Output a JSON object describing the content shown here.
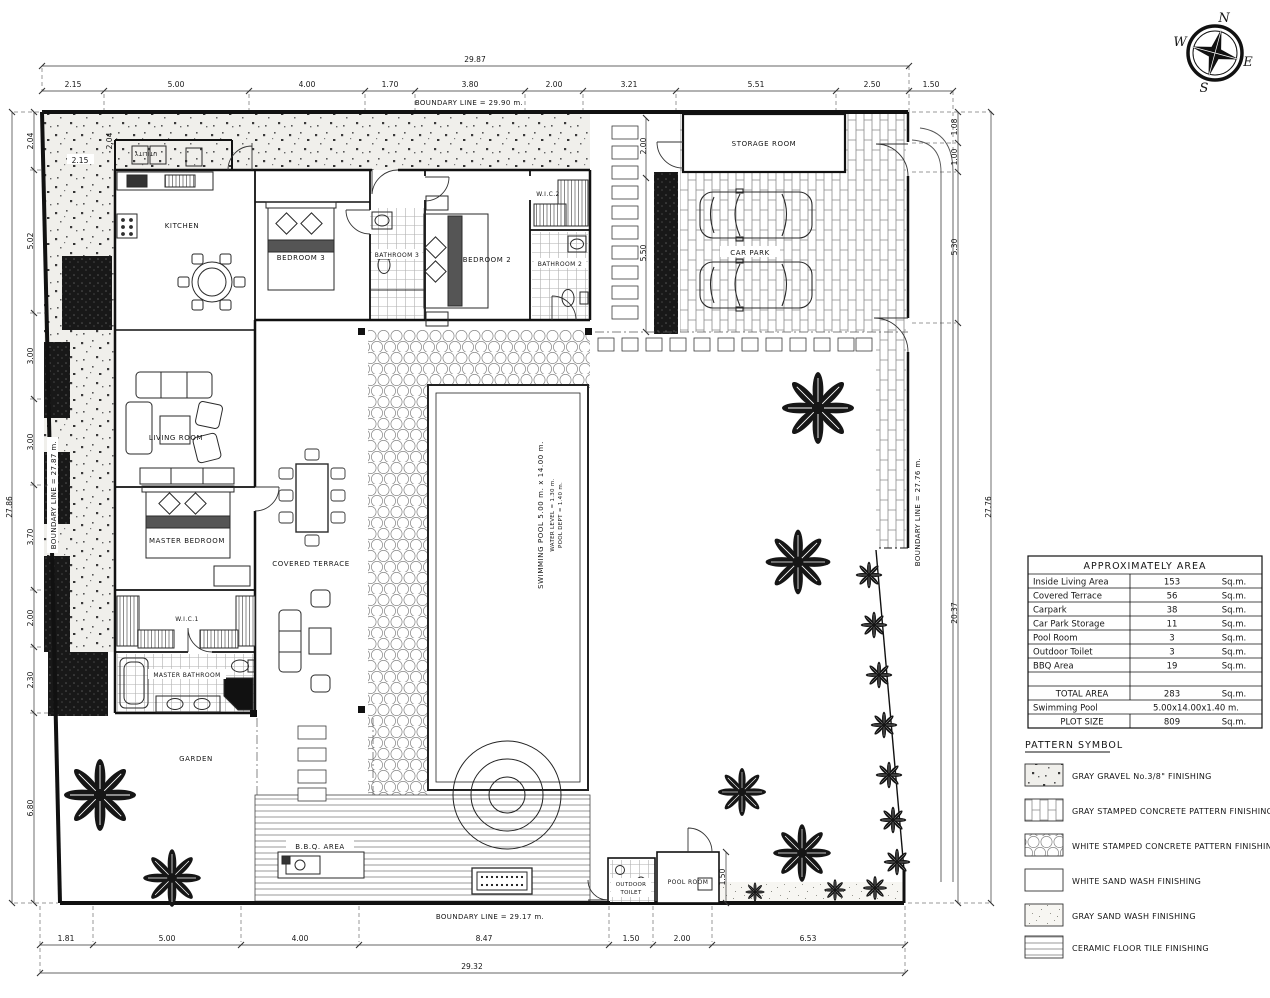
{
  "compass": {
    "n": "N",
    "e": "E",
    "s": "S",
    "w": "W"
  },
  "boundary": {
    "top": "BOUNDARY LINE = 29.90 m.",
    "bottom": "BOUNDARY LINE = 29.17 m.",
    "left": "BOUNDARY LINE = 27.87 m.",
    "right": "BOUNDARY LINE = 27.76 m."
  },
  "rooms": {
    "utility": "UTILITY",
    "kitchen": "KITCHEN",
    "bedroom3": "BEDROOM 3",
    "bathroom3": "BATHROOM 3",
    "bedroom2": "BEDROOM 2",
    "wic2": "W.I.C.2",
    "bathroom2": "BATHROOM 2",
    "storage": "STORAGE ROOM",
    "carpark": "CAR PARK",
    "living": "LIVING ROOM",
    "master_bedroom": "MASTER BEDROOM",
    "covered_terrace": "COVERED TERRACE",
    "wic1": "W.I.C.1",
    "master_bathroom": "MASTER BATHROOM",
    "garden": "GARDEN",
    "bbq": "B.B.Q. AREA",
    "outdoor_toilet": {
      "line1": "OUTDOOR",
      "line2": "TOILET"
    },
    "pool_room": "POOL ROOM"
  },
  "pool": {
    "line1": "SWIMMING POOL 5.00 m. x 14.00 m.",
    "line2": "WATER LEVEL = 1.30 m.",
    "line3": "POOL DEPT = 1.40 m."
  },
  "dims": {
    "top": {
      "overall": "29.87",
      "segments": [
        "2.15",
        "5.00",
        "4.00",
        "1.70",
        "3.80",
        "2.00",
        "3.21",
        "5.51",
        "2.50",
        "1.50"
      ]
    },
    "bottom": {
      "overall": "29.32",
      "segments": [
        "1.81",
        "5.00",
        "4.00",
        "8.47",
        "1.50",
        "2.00",
        "6.53"
      ]
    },
    "left": {
      "overall": "27.86",
      "segments": [
        "2.04",
        "5.02",
        "3.00",
        "3.00",
        "3.70",
        "2.00",
        "2.30",
        "6.80"
      ]
    },
    "right": {
      "overall": "27.76",
      "segments": [
        "1.08",
        "1.00",
        "5.30",
        "20.37"
      ]
    },
    "internal": {
      "walkway_top": "2.00",
      "walkway": "5.50",
      "pool_room": "1.50",
      "kitchen": "2.15",
      "utility": "2.04"
    }
  },
  "area_table": {
    "title": "APPROXIMATELY AREA",
    "rows": [
      {
        "name": "Inside Living Area",
        "value": "153",
        "unit": "Sq.m."
      },
      {
        "name": "Covered Terrace",
        "value": "56",
        "unit": "Sq.m."
      },
      {
        "name": "Carpark",
        "value": "38",
        "unit": "Sq.m."
      },
      {
        "name": "Car Park Storage",
        "value": "11",
        "unit": "Sq.m."
      },
      {
        "name": "Pool Room",
        "value": "3",
        "unit": "Sq.m."
      },
      {
        "name": "Outdoor Toilet",
        "value": "3",
        "unit": "Sq.m."
      },
      {
        "name": "BBQ Area",
        "value": "19",
        "unit": "Sq.m."
      }
    ],
    "total": {
      "label": "TOTAL AREA",
      "value": "283",
      "unit": "Sq.m."
    },
    "swimming": {
      "label": "Swimming Pool",
      "value": "5.00x14.00x1.40 m."
    },
    "plot": {
      "label": "PLOT SIZE",
      "value": "809",
      "unit": "Sq.m."
    }
  },
  "legend": {
    "title": "PATTERN SYMBOL",
    "items": [
      {
        "label": "GRAY GRAVEL No.3/8\" FINISHING",
        "pattern": "gravel"
      },
      {
        "label": "GRAY STAMPED CONCRETE PATTERN FINISHING",
        "pattern": "brick"
      },
      {
        "label": "WHITE STAMPED CONCRETE PATTERN FINISHING",
        "pattern": "hex"
      },
      {
        "label": "WHITE SAND WASH FINISHING",
        "pattern": "white"
      },
      {
        "label": "GRAY SAND WASH FINISHING",
        "pattern": "sand"
      },
      {
        "label": "CERAMIC FLOOR TILE FINISHING",
        "pattern": "tile"
      }
    ]
  }
}
